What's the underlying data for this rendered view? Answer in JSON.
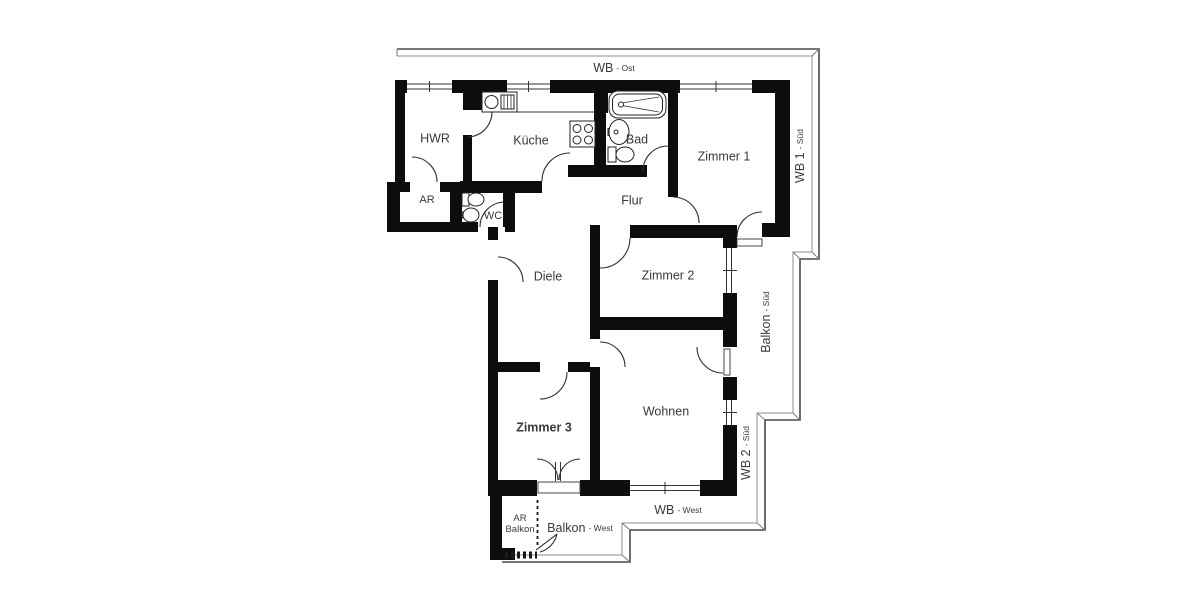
{
  "rooms": [
    {
      "id": "hwr",
      "label": "HWR"
    },
    {
      "id": "kueche",
      "label": "Küche"
    },
    {
      "id": "bad",
      "label": "Bad"
    },
    {
      "id": "zimmer1",
      "label": "Zimmer 1"
    },
    {
      "id": "ar",
      "label": "AR"
    },
    {
      "id": "wc",
      "label": "WC"
    },
    {
      "id": "flur",
      "label": "Flur"
    },
    {
      "id": "diele",
      "label": "Diele"
    },
    {
      "id": "zimmer2",
      "label": "Zimmer 2"
    },
    {
      "id": "zimmer3",
      "label": "Zimmer 3"
    },
    {
      "id": "wohnen",
      "label": "Wohnen"
    }
  ],
  "outdoor": [
    {
      "id": "wb-ost",
      "main": "WB",
      "suffix": "- Ost"
    },
    {
      "id": "wb1-sued",
      "main": "WB 1",
      "suffix": "- Süd"
    },
    {
      "id": "balkon-sued",
      "main": "Balkon",
      "suffix": "- Süd"
    },
    {
      "id": "wb2-sued",
      "main": "WB 2",
      "suffix": "- Süd"
    },
    {
      "id": "wb-west",
      "main": "WB",
      "suffix": "- West"
    },
    {
      "id": "balkon-west",
      "main": "Balkon",
      "suffix": "- West"
    },
    {
      "id": "ar-balkon",
      "main": "AR",
      "suffix": "Balkon"
    }
  ],
  "icons": [
    "kitchen-sink-icon",
    "stove-icon",
    "bathtub-icon",
    "washbasin-icon",
    "toilet-icon",
    "wc-toilet-icon",
    "wc-washbasin-icon"
  ],
  "colors": {
    "wall": "#0d0d0d",
    "line": "#333333",
    "frame_outer": "#4a4a4a",
    "frame_inner": "#8d8d8d",
    "label": "#3a3a3a",
    "background": "#ffffff"
  }
}
